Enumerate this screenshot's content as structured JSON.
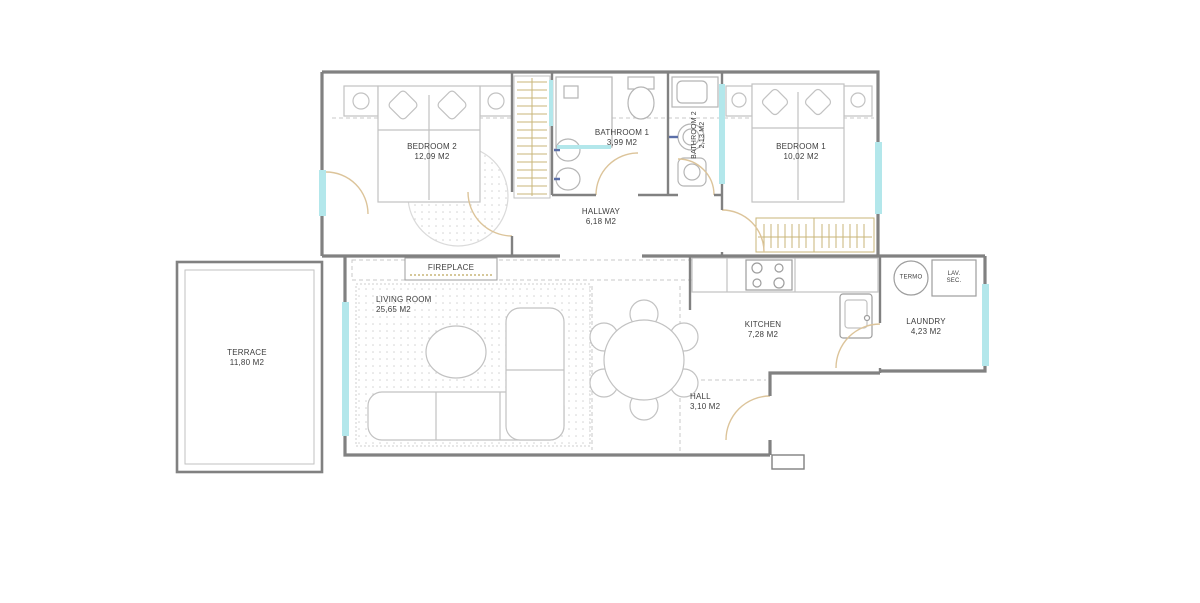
{
  "plan_title": "apartment-floor-plan",
  "colors": {
    "wall": "#818181",
    "window": "#b3e7eb",
    "furniture": "#c2c2c2",
    "wood": "#c8b578",
    "door_arc": "#dcc49a",
    "text": "#3d3d3d"
  },
  "rooms": {
    "bedroom2": {
      "name": "BEDROOM 2",
      "area": "12,09 M2"
    },
    "bathroom1": {
      "name": "BATHROOM 1",
      "area": "3,99 M2"
    },
    "bathroom2": {
      "name": "BATHROOM 2",
      "area": "2,13 M2"
    },
    "bedroom1": {
      "name": "BEDROOM 1",
      "area": "10,02 M2"
    },
    "hallway": {
      "name": "HALLWAY",
      "area": "6,18 M2"
    },
    "living_room": {
      "name": "LIVING ROOM",
      "area": "25,65 M2"
    },
    "terrace": {
      "name": "TERRACE",
      "area": "11,80 M2"
    },
    "kitchen": {
      "name": "KITCHEN",
      "area": "7,28 M2"
    },
    "laundry": {
      "name": "LAUNDRY",
      "area": "4,23 M2"
    },
    "hall": {
      "name": "HALL",
      "area": "3,10 M2"
    }
  },
  "fixtures": {
    "fireplace": "FIREPLACE",
    "termo": "TERMO",
    "lav_sec_line1": "LAV.",
    "lav_sec_line2": "SEC."
  }
}
